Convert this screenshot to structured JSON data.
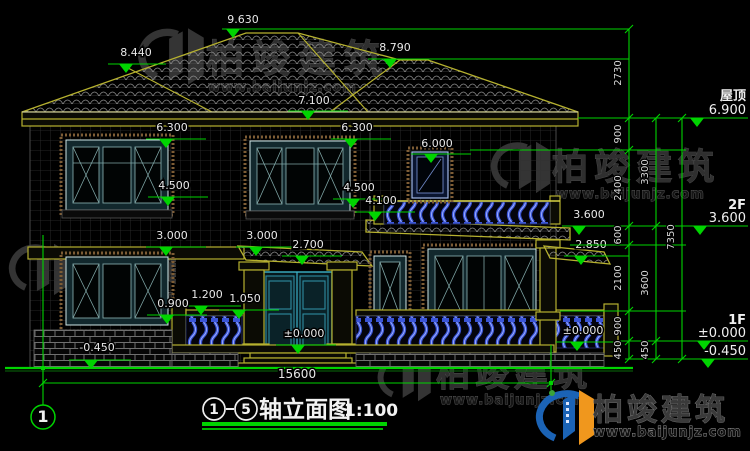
{
  "title": {
    "axis_from": "1",
    "axis_to": "5",
    "name": "轴立面图",
    "scale": "1:100"
  },
  "axis": {
    "left_bubble": "1"
  },
  "dims": {
    "total_width": "15600",
    "chain_inner": {
      "s2730": "2730",
      "s900a": "900",
      "s2400": "2400",
      "s600": "600",
      "s2100": "2100",
      "s900b": "900",
      "s450a": "450"
    },
    "chain_mid": {
      "s3300": "3300",
      "s3600": "3600",
      "s450b": "450"
    },
    "chain_outer": {
      "s7350": "7350"
    }
  },
  "levels": {
    "l9630": "9.630",
    "l8440": "8.440",
    "l8790": "8.790",
    "l7100": "7.100",
    "l6300a": "6.300",
    "l6300b": "6.300",
    "l6000": "6.000",
    "l4500a": "4.500",
    "l4500b": "4.500",
    "l4100": "4.100",
    "l3600": "3.600",
    "l3000a": "3.000",
    "l3000b": "3.000",
    "l2850": "2.850",
    "l2700": "2.700",
    "l1200": "1.200",
    "l1050": "1.050",
    "l0900": "0.900",
    "l0000a": "±0.000",
    "l0000b": "±0.000",
    "ln0450": "-0.450"
  },
  "floor_levels": {
    "roof_label": "屋顶",
    "roof_value": "6.900",
    "f2_label": "2F",
    "f2_value": "3.600",
    "f1_label": "1F",
    "f1_value": "±0.000",
    "base_value": "-0.450"
  },
  "watermark": {
    "brand": "柏竣建筑",
    "url": "www.baijunjz.com"
  },
  "colors": {
    "dim_green": "#00d400",
    "cad_olive": "#b6b12f",
    "window_teal": "#2e8ba0",
    "baluster_blue": "#3b55d6",
    "logo_blue": "#1b63b5",
    "logo_orange": "#f0971d"
  }
}
